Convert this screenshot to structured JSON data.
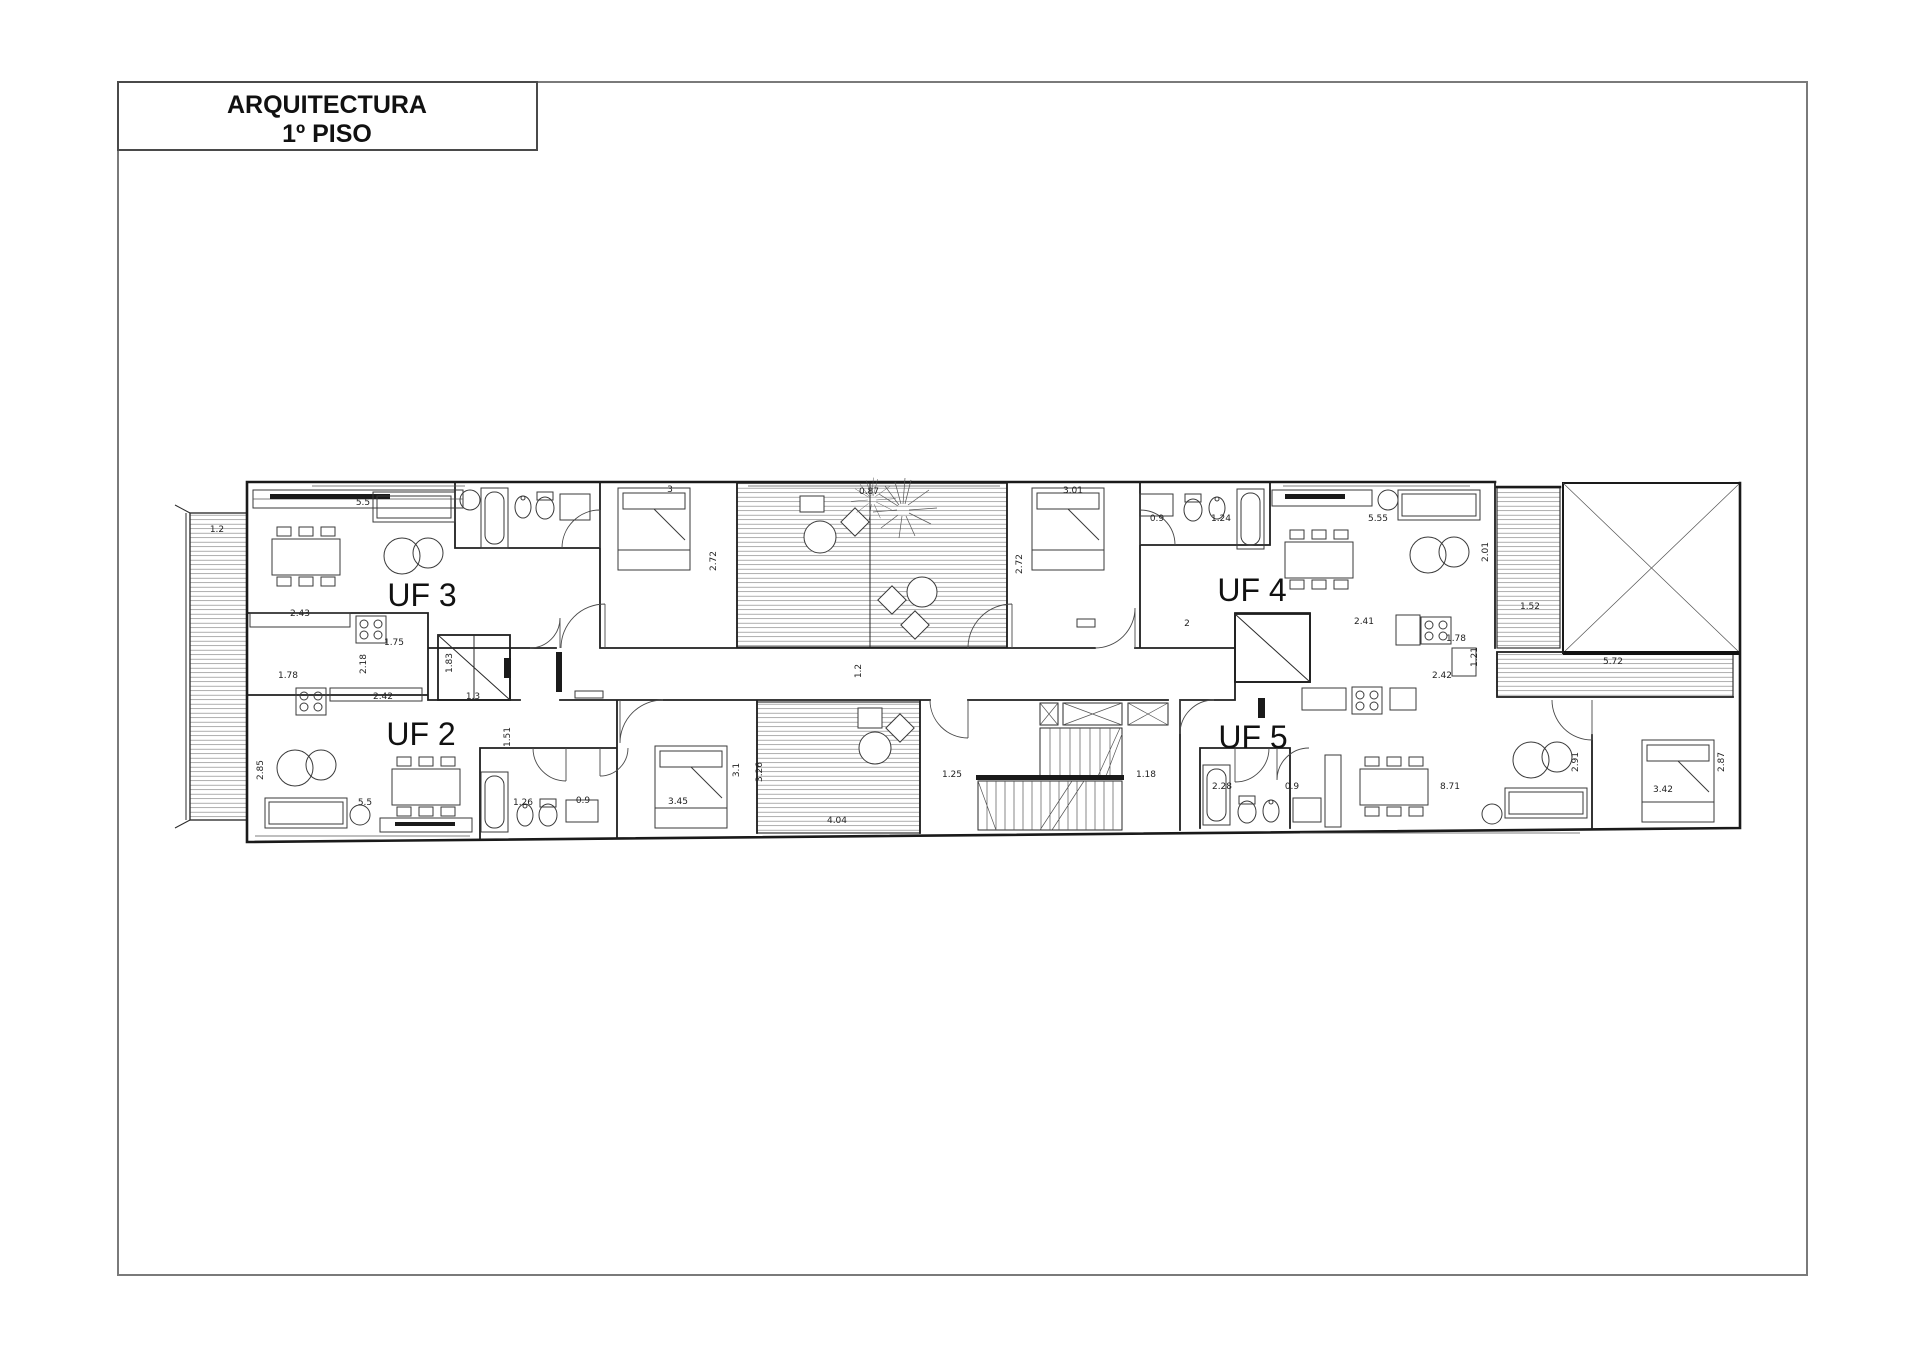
{
  "page": {
    "title_block": {
      "line1": "ARQUITECTURA",
      "line2": "1º PISO"
    }
  },
  "plan": {
    "units": [
      {
        "id": "uf2",
        "label": "UF 2"
      },
      {
        "id": "uf3",
        "label": "UF 3"
      },
      {
        "id": "uf4",
        "label": "UF 4"
      },
      {
        "id": "uf5",
        "label": "UF 5"
      }
    ],
    "dimensions": [
      "5.5",
      "1.2",
      "2.43",
      "1.75",
      "2.18",
      "1.78",
      "1.83",
      "1.3",
      "2.42",
      "3",
      "2.72",
      "0.87",
      "3.01",
      "2.72",
      "0.9",
      "1.24",
      "5.55",
      "2.01",
      "1.52",
      "5.72",
      "1.2",
      "2",
      "2.41",
      "1.78",
      "2.42",
      "1.21",
      "3.45",
      "3.1",
      "3.26",
      "4.04",
      "1.25",
      "1.18",
      "2.85",
      "5.5",
      "1.26",
      "2.28",
      "0.9",
      "8.71",
      "2.91",
      "2.87",
      "3.42",
      "1.51",
      "0.9"
    ]
  },
  "colors": {
    "line": "#1a1a1a",
    "hatch": "#8a8a8a",
    "paper": "#ffffff",
    "frame": "#7a7a7a"
  }
}
